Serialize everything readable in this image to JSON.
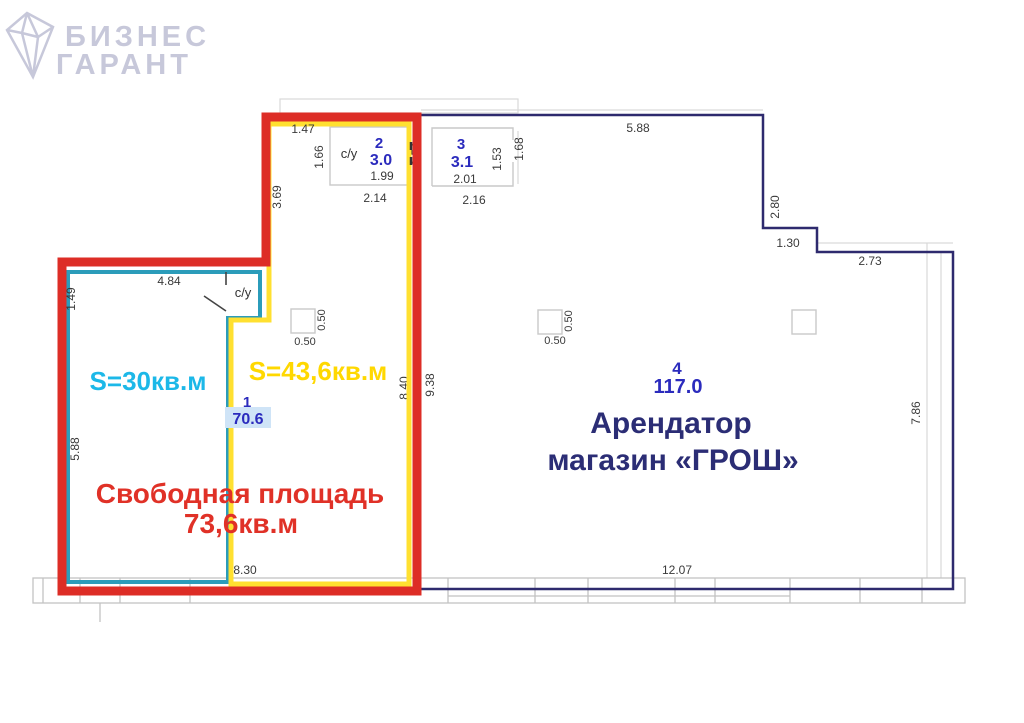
{
  "logo": {
    "line1": "БИЗНЕС",
    "line2": "ГАРАНТ",
    "color": "#c7c8da"
  },
  "plan": {
    "areas": {
      "free": {
        "line1": "Свободная площадь",
        "line2": "73,6кв.м",
        "color": "#e03127"
      },
      "left_unit": {
        "label": "S=30кв.м",
        "color": "#1cb8e8"
      },
      "middle_unit": {
        "label": "S=43,6кв.м",
        "color": "#ffd800"
      },
      "tenant": {
        "line1": "Арендатор",
        "line2": "магазин «ГРОШ»",
        "color": "#2b2d75"
      }
    },
    "rooms": {
      "room1": {
        "number": "1",
        "area": "70.6"
      },
      "room2": {
        "number": "2",
        "area": "3.0",
        "label": "с/у"
      },
      "room3": {
        "number": "3",
        "area": "3.1"
      },
      "room4": {
        "number": "4",
        "area": "117.0"
      },
      "su_left": {
        "label": "с/у"
      }
    },
    "dims": {
      "top_147": "1.47",
      "v_166": "1.66",
      "b_199": "1.99",
      "b_214": "2.14",
      "v_369": "3.69",
      "v_154": "1.54",
      "b_201": "2.01",
      "b_216": "2.16",
      "v_153": "1.53",
      "v_168": "1.68",
      "top_588": "5.88",
      "v_280": "2.80",
      "h_130": "1.30",
      "h_273": "2.73",
      "v_786": "7.86",
      "v_938": "9.38",
      "v_840": "8.40",
      "p1_h": "0.50",
      "p1_v": "0.50",
      "p2_h": "0.50",
      "p2_v": "0.50",
      "h_484": "4.84",
      "v_149": "1.49",
      "v_588_left": "5.88",
      "bottom_830": "8.30",
      "bottom_1207": "12.07"
    },
    "outline_colors": {
      "free_outline": "#dd2d26",
      "unit30_outline": "#2b9cba",
      "unit436_outline": "#ffe030",
      "tenant_outline": "#2e2a6e"
    }
  }
}
